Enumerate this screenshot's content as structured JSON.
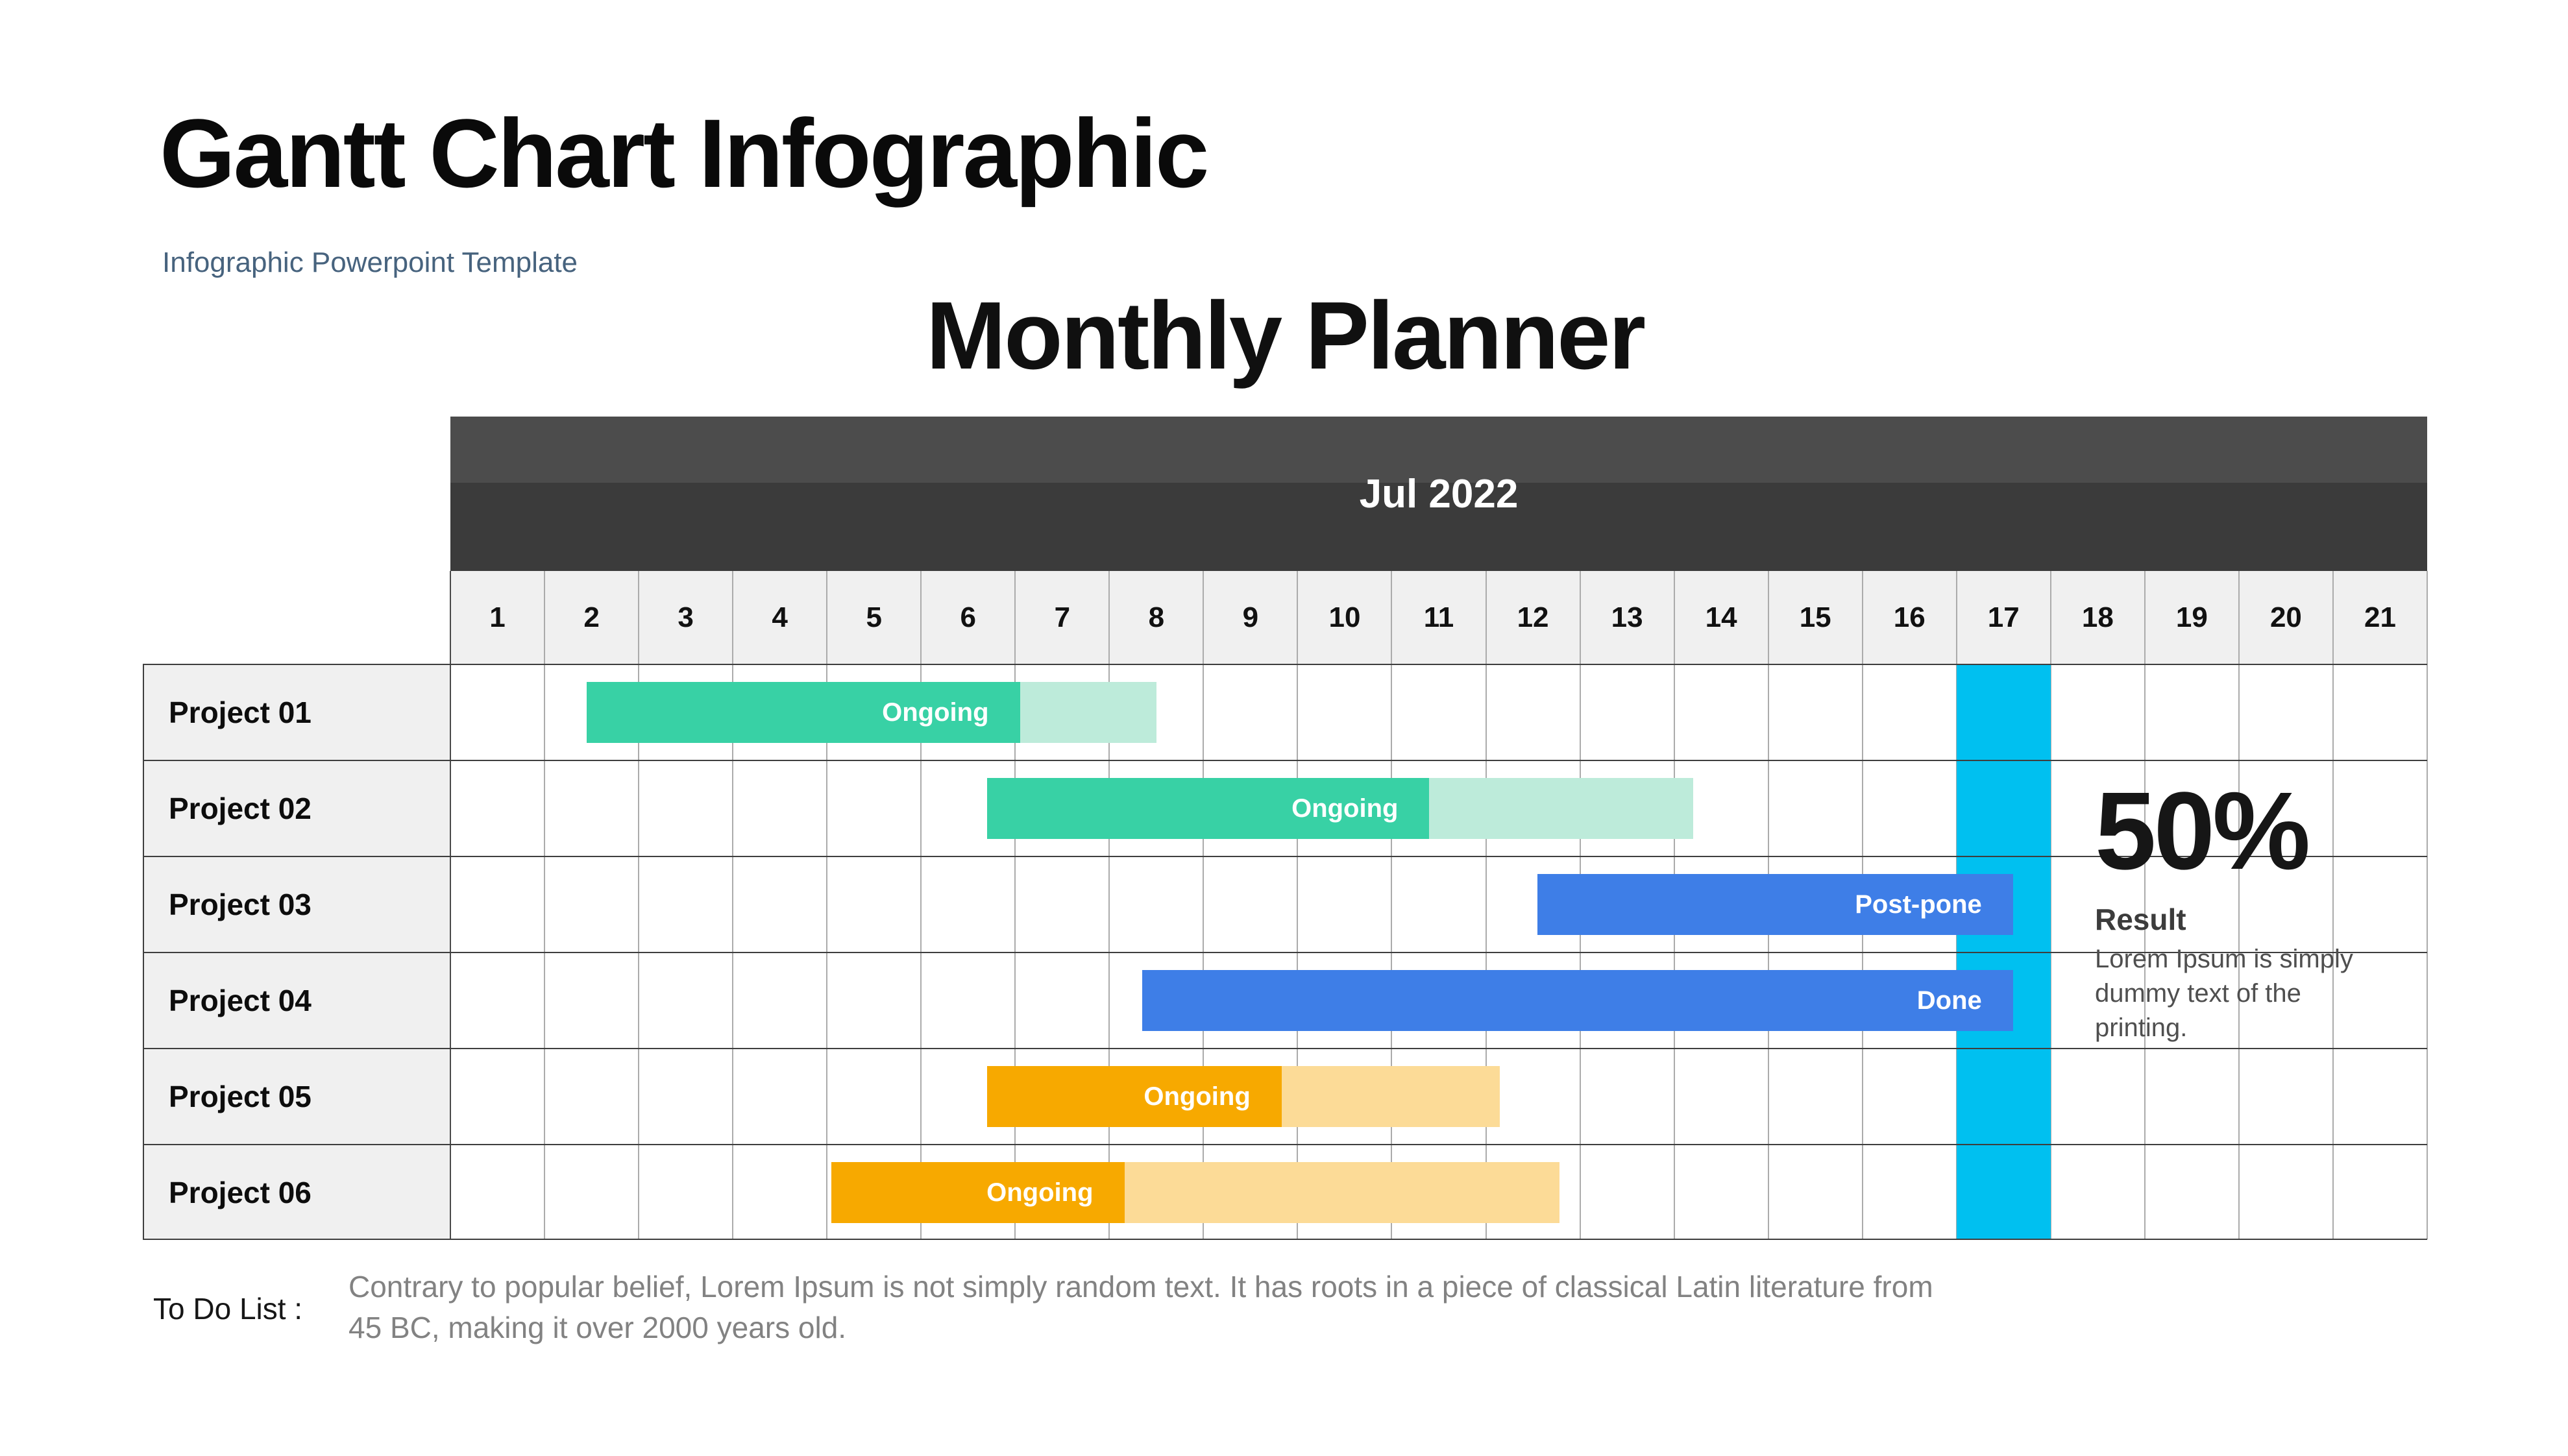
{
  "header": {
    "title": "Gantt Chart Infographic",
    "subtitle": "Infographic Powerpoint Template"
  },
  "planner": {
    "title": "Monthly Planner",
    "month_label": "Jul 2022"
  },
  "result": {
    "percent": "50%",
    "title": "Result",
    "text": "Lorem Ipsum is simply dummy text of the printing."
  },
  "todo": {
    "label": "To Do List :",
    "text": "Contrary to popular belief, Lorem Ipsum is not simply random text. It has roots in a piece of classical Latin literature from 45 BC, making it over 2000 years old."
  },
  "colors": {
    "teal": "#38d1a5",
    "teal_light": "#bdebda",
    "blue": "#3e7ee7",
    "orange": "#f7a900",
    "orange_light": "#fcdb97",
    "highlight": "#00c0f0",
    "header_dark_top": "#4c4c4c",
    "header_dark_bottom": "#3b3b3b",
    "row_bg": "#f0f0f0",
    "subtitle_accent": "#47637e"
  },
  "chart_data": {
    "type": "gantt",
    "title": "Monthly Planner",
    "month": "Jul 2022",
    "day_labels": [
      "1",
      "2",
      "3",
      "4",
      "5",
      "6",
      "7",
      "8",
      "9",
      "10",
      "11",
      "12",
      "13",
      "14",
      "15",
      "16",
      "17",
      "18",
      "19",
      "20",
      "21"
    ],
    "highlight_day": 17,
    "legend": "solid segment = elapsed/progress, light segment = planned remainder",
    "tasks": [
      {
        "name": "Project 01",
        "status": "Ongoing",
        "variant": "teal",
        "start_day": 2.45,
        "progress_end_day": 7.05,
        "end_day": 8.5
      },
      {
        "name": "Project 02",
        "status": "Ongoing",
        "variant": "teal",
        "start_day": 6.7,
        "progress_end_day": 11.4,
        "end_day": 14.2
      },
      {
        "name": "Project 03",
        "status": "Post-pone",
        "variant": "blue",
        "start_day": 12.55,
        "progress_end_day": 17.6,
        "end_day": 17.6
      },
      {
        "name": "Project 04",
        "status": "Done",
        "variant": "blue",
        "start_day": 8.35,
        "progress_end_day": 17.6,
        "end_day": 17.6
      },
      {
        "name": "Project 05",
        "status": "Ongoing",
        "variant": "orange",
        "start_day": 6.7,
        "progress_end_day": 9.83,
        "end_day": 12.15
      },
      {
        "name": "Project 06",
        "status": "Ongoing",
        "variant": "orange",
        "start_day": 5.05,
        "progress_end_day": 8.16,
        "end_day": 12.78
      }
    ]
  }
}
